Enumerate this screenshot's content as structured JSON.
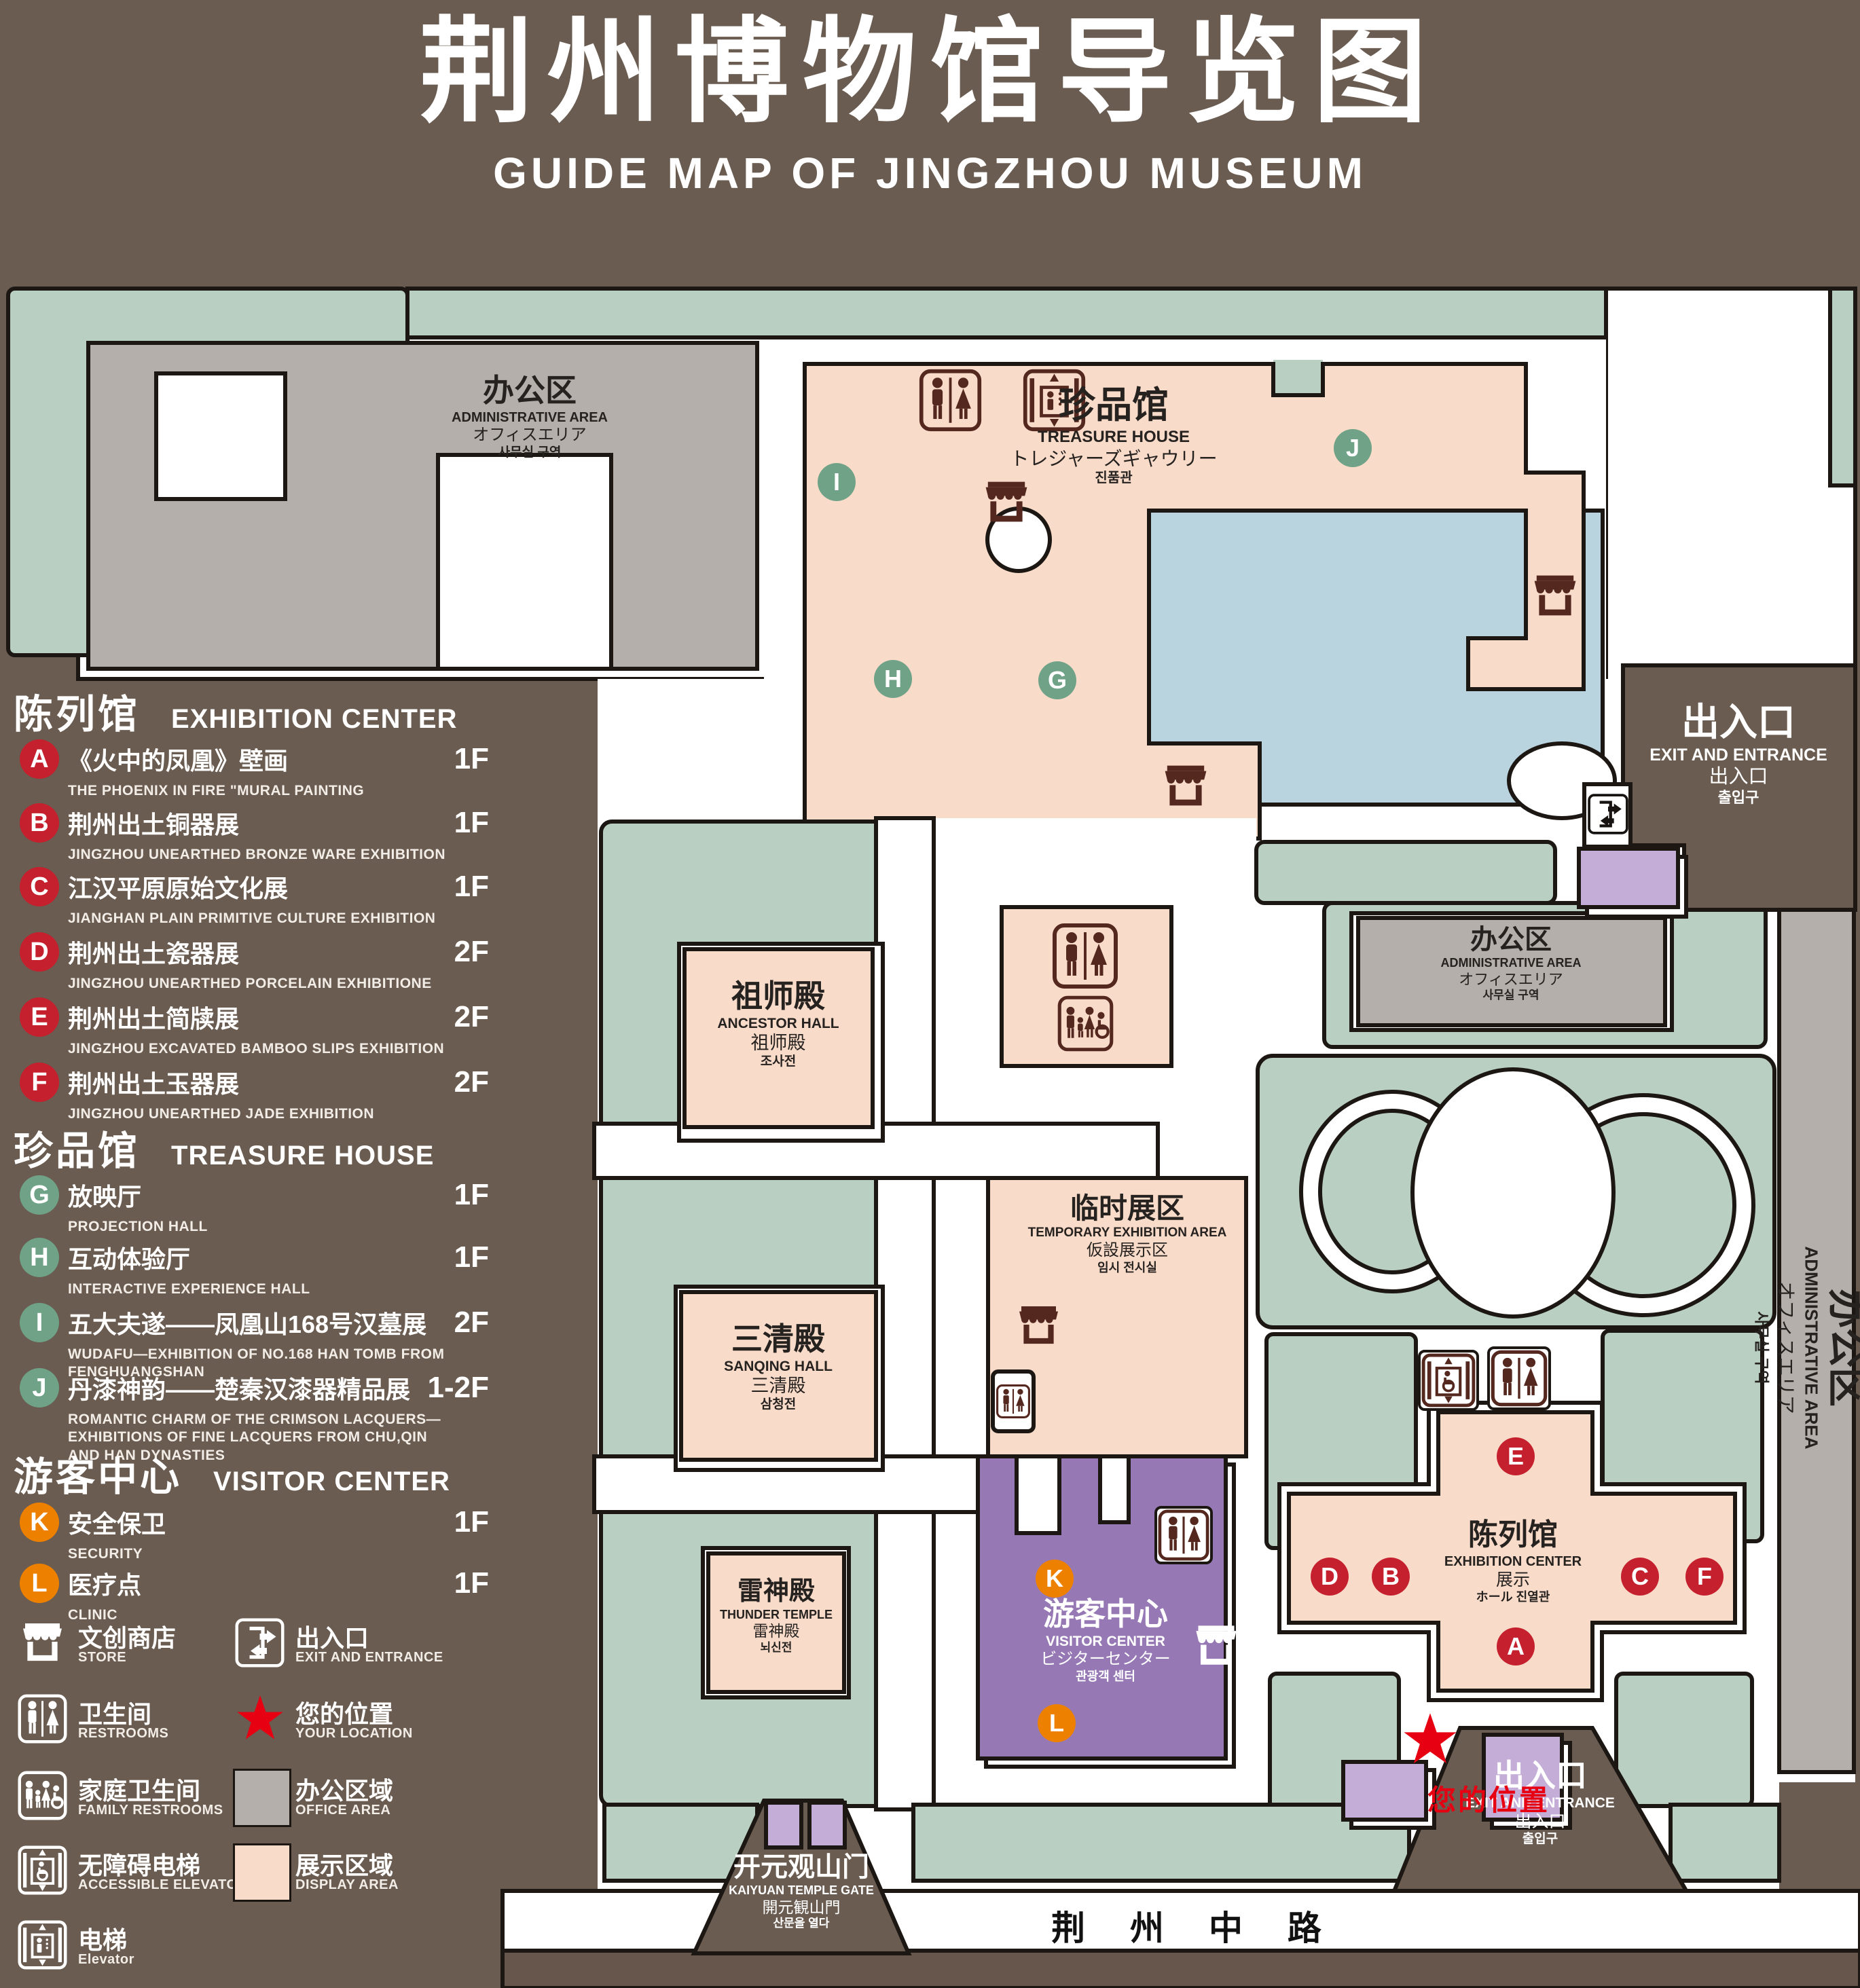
{
  "title": {
    "zh": "荆州博物馆导览图",
    "en": "GUIDE MAP OF JINGZHOU MUSEUM"
  },
  "colors": {
    "background": "#6a5c51",
    "landscape_green": "#b9cfc1",
    "display_pink": "#f9dbc9",
    "office_gray": "#b4afaa",
    "visitor_purple": "#9678b4",
    "gate_purple": "#c4aed8",
    "water_blue": "#b9d3df",
    "icon_brown": "#54281e",
    "marker_red": "#c5202e",
    "marker_green": "#6fa287",
    "marker_orange": "#ee8000",
    "star_red": "#e60012",
    "outline": "#1c1713"
  },
  "legend": {
    "sections": [
      {
        "zh": "陈列馆",
        "en": "EXHIBITION CENTER",
        "items": [
          {
            "letter": "A",
            "zh": "《火中的凤凰》壁画",
            "en": "THE PHOENIX IN FIRE \"MURAL PAINTING",
            "floor": "1F"
          },
          {
            "letter": "B",
            "zh": "荆州出土铜器展",
            "en": "JINGZHOU UNEARTHED BRONZE WARE EXHIBITION",
            "floor": "1F"
          },
          {
            "letter": "C",
            "zh": "江汉平原原始文化展",
            "en": "JIANGHAN PLAIN PRIMITIVE CULTURE EXHIBITION",
            "floor": "1F"
          },
          {
            "letter": "D",
            "zh": "荆州出土瓷器展",
            "en": "JINGZHOU UNEARTHED PORCELAIN EXHIBITIONE",
            "floor": "2F"
          },
          {
            "letter": "E",
            "zh": "荆州出土简牍展",
            "en": "JINGZHOU EXCAVATED BAMBOO SLIPS EXHIBITION",
            "floor": "2F"
          },
          {
            "letter": "F",
            "zh": "荆州出土玉器展",
            "en": "JINGZHOU UNEARTHED JADE EXHIBITION",
            "floor": "2F"
          }
        ]
      },
      {
        "zh": "珍品馆",
        "en": "TREASURE HOUSE",
        "items": [
          {
            "letter": "G",
            "zh": "放映厅",
            "en": "PROJECTION HALL",
            "floor": "1F"
          },
          {
            "letter": "H",
            "zh": "互动体验厅",
            "en": "INTERACTIVE EXPERIENCE HALL",
            "floor": "1F"
          },
          {
            "letter": "I",
            "zh": "五大夫遂——凤凰山168号汉墓展",
            "en": "WUDAFU—EXHIBITION OF NO.168 HAN TOMB FROM FENGHUANGSHAN",
            "floor": "2F"
          },
          {
            "letter": "J",
            "zh": "丹漆神韵——楚秦汉漆器精品展",
            "en": "ROMANTIC CHARM OF THE CRIMSON LACQUERS—EXHIBITIONS OF FINE LACQUERS FROM CHU,QIN AND HAN DYNASTIES",
            "floor": "1-2F"
          }
        ]
      },
      {
        "zh": "游客中心",
        "en": "VISITOR CENTER",
        "items": [
          {
            "letter": "K",
            "zh": "安全保卫",
            "en": "SECURITY",
            "floor": "1F"
          },
          {
            "letter": "L",
            "zh": "医疗点",
            "en": "CLINIC",
            "floor": "1F"
          }
        ]
      }
    ],
    "symbols_col1": [
      {
        "zh": "文创商店",
        "en": "STORE"
      },
      {
        "zh": "卫生间",
        "en": "RESTROOMS"
      },
      {
        "zh": "家庭卫生间",
        "en": "FAMILY RESTROOMS"
      },
      {
        "zh": "无障碍电梯",
        "en": "ACCESSIBLE  ELEVATOR"
      },
      {
        "zh": "电梯",
        "en": "Elevator"
      }
    ],
    "symbols_col2": [
      {
        "zh": "出入口",
        "en": "EXIT AND ENTRANCE"
      },
      {
        "zh": "您的位置",
        "en": "YOUR LOCATION"
      },
      {
        "zh": "办公区域",
        "en": "OFFICE AREA"
      },
      {
        "zh": "展示区域",
        "en": "DISPLAY AREA"
      }
    ]
  },
  "map": {
    "labels": {
      "admin_tl": {
        "zh": "办公区",
        "en": "ADMINISTRATIVE AREA",
        "ja": "オフィスエリア",
        "ko": "사무실 구역"
      },
      "treasure": {
        "zh": "珍品馆",
        "en": "TREASURE HOUSE",
        "ja": "トレジャーズギャウリー",
        "ko": "진품관"
      },
      "ancestor": {
        "zh": "祖师殿",
        "en": "ANCESTOR HALL",
        "zh2": "祖师殿",
        "ko": "조사전"
      },
      "temp": {
        "zh": "临时展区",
        "en": "TEMPORARY EXHIBITION AREA",
        "ja": "仮設展示区",
        "ko": "임시 전시실"
      },
      "admin_r": {
        "zh": "办公区",
        "en": "ADMINISTRATIVE AREA",
        "ja": "オフィスエリア",
        "ko": "사무실 구역"
      },
      "admin_strip": {
        "zh": "办公区",
        "en": "ADMINISTRATIVE AREA",
        "ja": "オフィスエリア",
        "ko": "사무실 구역"
      },
      "sanqing": {
        "zh": "三清殿",
        "en": "SANQING HALL",
        "zh2": "三清殿",
        "ko": "삼청전"
      },
      "thunder": {
        "zh": "雷神殿",
        "en": "THUNDER TEMPLE",
        "zh2": "雷神殿",
        "ko": "뇌신전"
      },
      "visitor": {
        "zh": "游客中心",
        "en": "VISITOR CENTER",
        "ja": "ビジターセンター",
        "ko": "관광객 센터"
      },
      "exhibition": {
        "zh": "陈列馆",
        "en": "EXHIBITION CENTER",
        "zh2": "展示",
        "ko": "ホール 진열관"
      },
      "exit_tr": {
        "zh": "出入口",
        "en": "EXIT AND ENTRANCE",
        "zh2": "出入口",
        "ko": "출입구"
      },
      "exit_br": {
        "zh": "出入口",
        "en": "EXIT AND ENTRANCE",
        "zh2": "出入口",
        "ko": "출입구"
      },
      "gate": {
        "zh": "开元观山门",
        "en": "KAIYUAN TEMPLE GATE",
        "ja": "開元観山門",
        "ko": "산문을 열다"
      },
      "road": {
        "zh": "荆 州 中 路"
      },
      "your_location": {
        "zh": "您的位置"
      }
    },
    "markers": {
      "a": "A",
      "b": "B",
      "c": "C",
      "d": "D",
      "e": "E",
      "f": "F",
      "g": "G",
      "h": "H",
      "i": "I",
      "j": "J",
      "k": "K",
      "l": "L"
    }
  }
}
